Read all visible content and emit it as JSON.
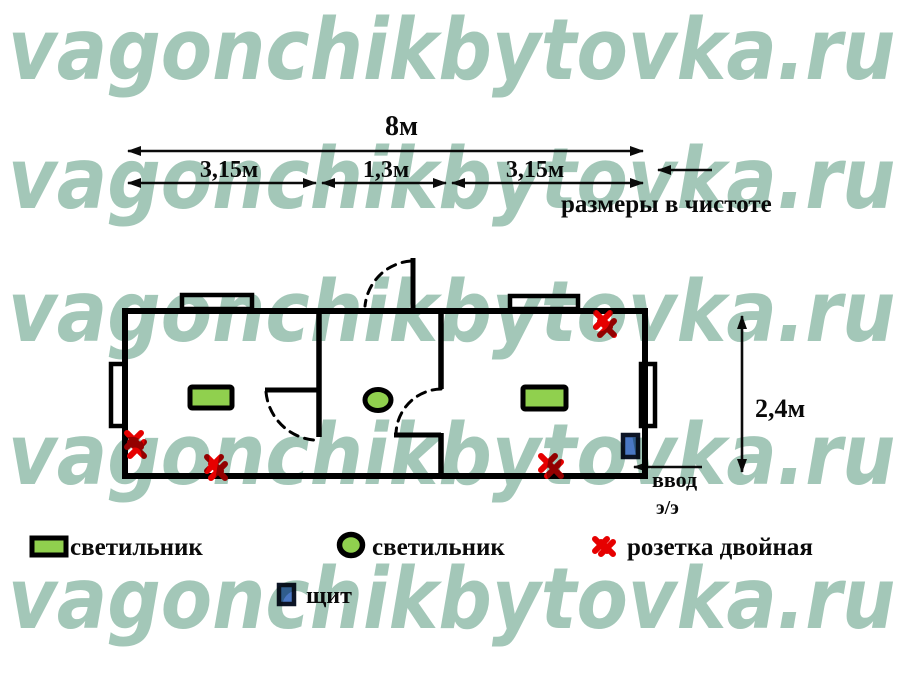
{
  "watermark": {
    "text": "vagonchikbytovka.ru",
    "color": "#a3c7b8",
    "rows": 5
  },
  "dimensions": {
    "total_width": "8м",
    "left_section": "3,15м",
    "middle_section": "1,3м",
    "right_section": "3,15м",
    "note": "размеры в чистоте",
    "height": "2,4м"
  },
  "plan": {
    "entry_label": "ввод",
    "entry_sublabel": "э/э"
  },
  "legend": {
    "light_rect_label": "светильник",
    "light_round_label": "светильник",
    "socket_label": "розетка двойная",
    "panel_label": "щит"
  },
  "colors": {
    "watermark_teal": "#a3c7b8",
    "light_green": "#90d04e",
    "socket_red": "#e60000",
    "panel_blue": "#4a77c4",
    "line_black": "#000000"
  }
}
